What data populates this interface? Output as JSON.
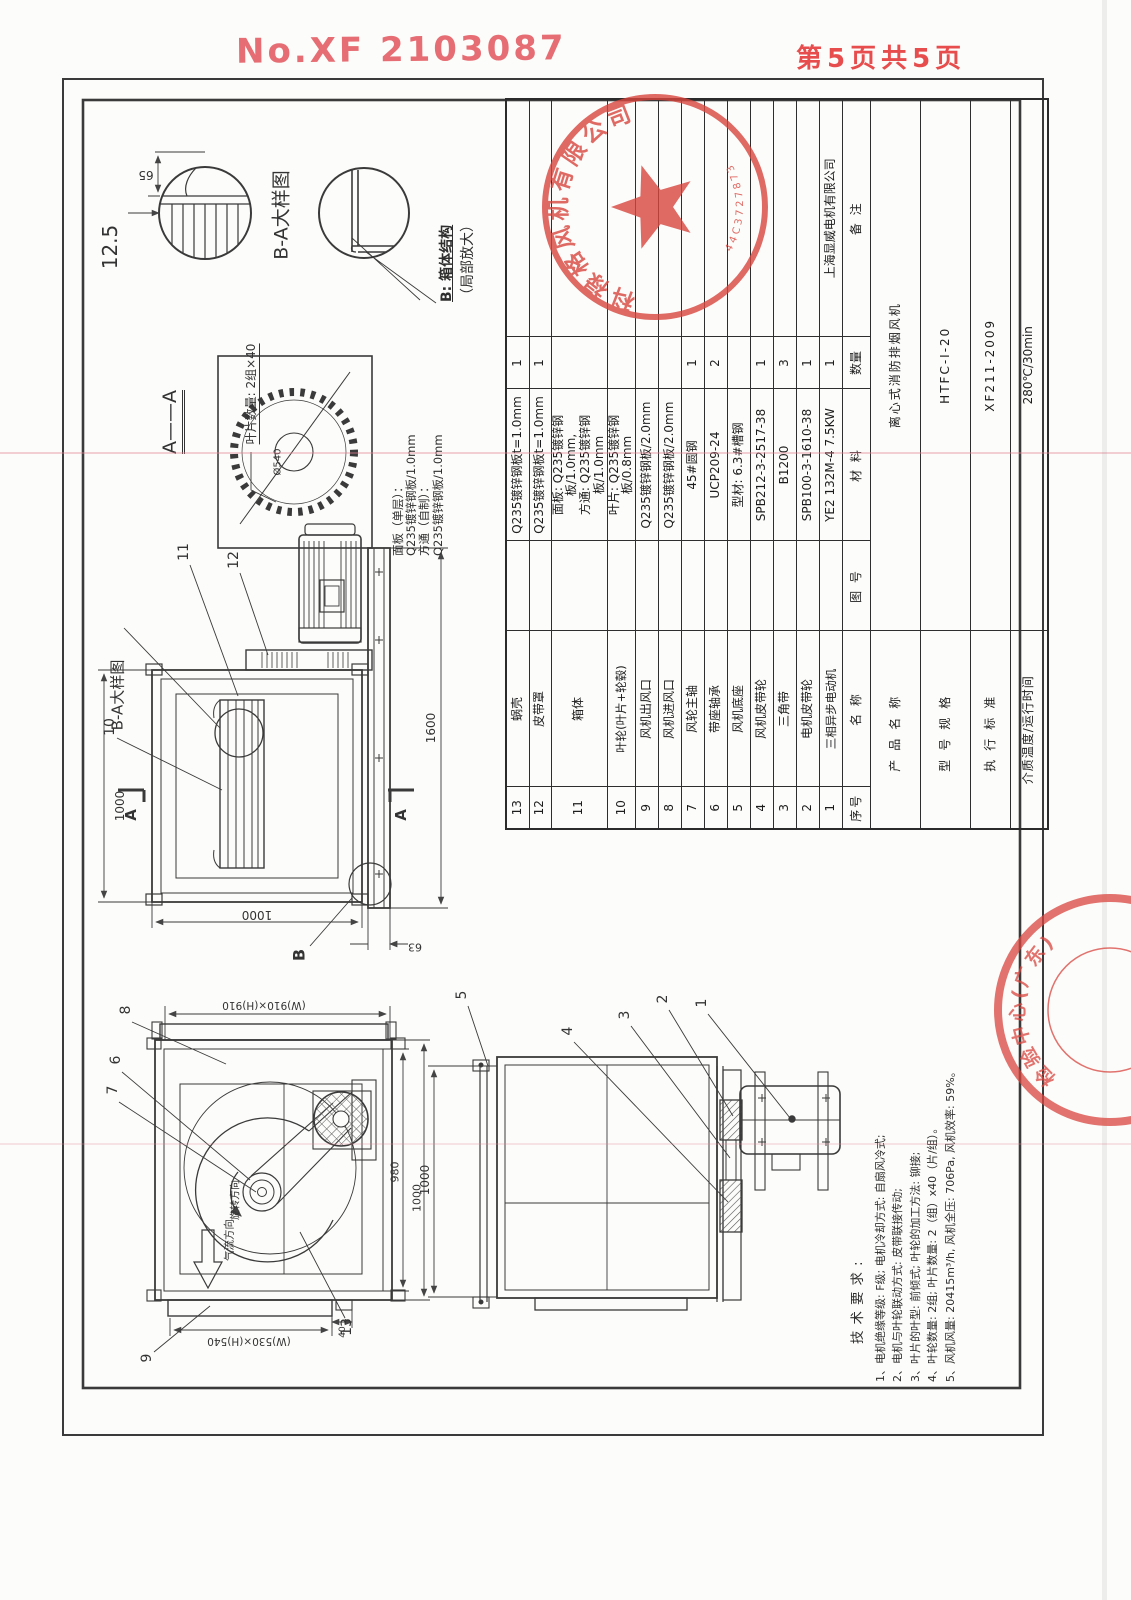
{
  "header": {
    "doc_no": "No.XF 2103087",
    "page_info": "第5页共5页"
  },
  "labels": {
    "ba": "B-A大样图",
    "aa": "A——A",
    "blade": "叶片数量: 2组×40",
    "rotation": "旋转方向",
    "airflow": "气流方向",
    "secA": "A",
    "secB": "B"
  },
  "dims": {
    "n65": "65",
    "n125": "12.5",
    "hub": "Ø540",
    "s_left": "1000",
    "s_bottom": "1000",
    "s_right": "1600",
    "n63": "63",
    "f_top": "(W)910×(H)910",
    "f_bottom": "(W)530×(H)540",
    "n980": "980",
    "f_1000": "1000",
    "n40": "40",
    "bv_1000": "1000"
  },
  "callouts": {
    "c1": "1",
    "c2": "2",
    "c3": "3",
    "c4": "4",
    "c5": "5",
    "c6": "6",
    "c7": "7",
    "c8": "8",
    "c9": "9",
    "c10": "10",
    "c11": "11",
    "c12": "12",
    "c13": "13"
  },
  "annotations": {
    "b_struct_line1": "B: 箱体结构",
    "b_struct_line2": "（局部放大）",
    "panel_l1": "面板（单层）：",
    "panel_l2": "Q235镀锌钢板/1.0mm",
    "panel_l3": "方通（自制）：",
    "panel_l4": "Q235镀锌钢板/1.0mm"
  },
  "title_block": {
    "headers": {
      "seq": "序号",
      "name": "名  称",
      "drawing_no": "图  号",
      "material": "材  料",
      "qty": "数量",
      "remark": "备  注"
    },
    "rows": [
      {
        "seq": "13",
        "name": "蜗壳",
        "drawing_no": "",
        "material": "Q235镀锌钢板t=1.0mm",
        "qty": "1",
        "remark": ""
      },
      {
        "seq": "12",
        "name": "皮带罩",
        "drawing_no": "",
        "material": "Q235镀锌钢板t=1.0mm",
        "qty": "1",
        "remark": ""
      },
      {
        "seq": "11",
        "name": "箱体",
        "drawing_no": "",
        "material": "面板: Q235镀锌钢板/1.0mm,\n方通: Q235镀锌钢板/1.0mm",
        "qty": "",
        "remark": ""
      },
      {
        "seq": "10",
        "name": "叶轮(叶片+轮毂)",
        "drawing_no": "",
        "material": "叶片: Q235镀锌钢板/0.8mm",
        "qty": "",
        "remark": ""
      },
      {
        "seq": "9",
        "name": "风机出风口",
        "drawing_no": "",
        "material": "Q235镀锌钢板/2.0mm",
        "qty": "",
        "remark": ""
      },
      {
        "seq": "8",
        "name": "风机进风口",
        "drawing_no": "",
        "material": "Q235镀锌钢板/2.0mm",
        "qty": "",
        "remark": ""
      },
      {
        "seq": "7",
        "name": "风轮主轴",
        "drawing_no": "",
        "material": "45#圆钢",
        "qty": "1",
        "remark": ""
      },
      {
        "seq": "6",
        "name": "带座轴承",
        "drawing_no": "",
        "material": "UCP209-24",
        "qty": "2",
        "remark": ""
      },
      {
        "seq": "5",
        "name": "风机底座",
        "drawing_no": "",
        "material": "型材: 6.3#槽钢",
        "qty": "",
        "remark": ""
      },
      {
        "seq": "4",
        "name": "风机皮带轮",
        "drawing_no": "",
        "material": "SPB212-3-2517-38",
        "qty": "1",
        "remark": ""
      },
      {
        "seq": "3",
        "name": "三角带",
        "drawing_no": "",
        "material": "B1200",
        "qty": "3",
        "remark": ""
      },
      {
        "seq": "2",
        "name": "电机皮带轮",
        "drawing_no": "",
        "material": "SPB100-3-1610-38",
        "qty": "1",
        "remark": ""
      },
      {
        "seq": "1",
        "name": "三相异步电动机",
        "drawing_no": "",
        "material": "YE2 132M-4  7.5KW",
        "qty": "1",
        "remark": "上海显威电机有限公司"
      }
    ],
    "product_rows": [
      {
        "label": "产品名称",
        "value": "离心式消防排烟风机"
      },
      {
        "label": "型号规格",
        "value": "HTFC-I-20"
      },
      {
        "label": "执行标准",
        "value": "XF211-2009"
      },
      {
        "label": "介质温度/运行时间",
        "value": "280℃/30min"
      }
    ]
  },
  "tech_notes": {
    "title": "技术要求:",
    "lines": [
      "1、电机绝缘等级: F级; 电机冷却方式: 自扇风冷式;",
      "2、电机与叶轮联动方式: 皮带联接传动;",
      "3、叶片的叶型: 前倾式; 叶轮的加工方法: 铆接;",
      "4、叶轮数量: 2组; 叶片数量: 2（组）x40（片/组）。",
      "5、风机风量: 20415m³/h, 风机全压: 706Pa, 风机效率: 59%。"
    ]
  },
  "seals": {
    "main": {
      "company": "科禄格风机有限公司",
      "number": "44C3727873"
    },
    "corner": {
      "arc_text": "检验中心(广东)",
      "inner_text": "汕头"
    }
  },
  "colors": {
    "stamp_red": "#d9453e",
    "line": "#3a3a3a"
  }
}
